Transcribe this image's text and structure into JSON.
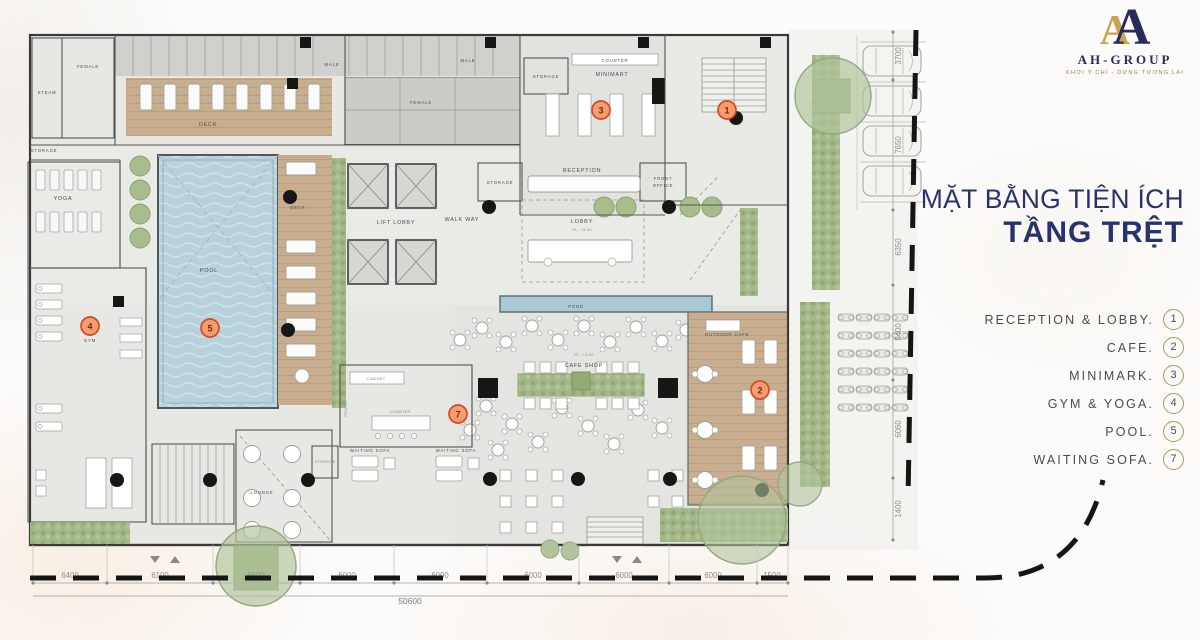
{
  "logo": {
    "letter": "A",
    "brand": "AH-GROUP",
    "tagline": "KHƠI Ý CHÍ - DỰNG TƯƠNG LAI"
  },
  "title": {
    "line1": "MẶT BẰNG TIỆN ÍCH",
    "line2": "TẦNG TRỆT"
  },
  "legend": {
    "items": [
      {
        "label": "RECEPTION & LOBBY.",
        "num": "1"
      },
      {
        "label": "CAFE.",
        "num": "2"
      },
      {
        "label": "MINIMARK.",
        "num": "3"
      },
      {
        "label": "GYM & YOGA.",
        "num": "4"
      },
      {
        "label": "POOL.",
        "num": "5"
      },
      {
        "label": "WAITING SOFA.",
        "num": "7"
      }
    ]
  },
  "plan": {
    "rooms": {
      "steam": "STEAM",
      "female_a": "FEMALE",
      "male_a": "MALE",
      "male_b": "MALE",
      "female_b": "FEMALE",
      "deck_top": "DECK",
      "deck_right": "DECK",
      "storage_a": "STORAGE",
      "storage_b": "STORAGE",
      "storage_c": "STORAGE",
      "storage_d": "STORAGE",
      "counter_a": "COUNTER",
      "counter_b": "COUNTER",
      "minimart": "MINIMART",
      "reception": "RECEPTION",
      "front_office_1": "FRONT",
      "front_office_2": "OFFICE",
      "lobby": "LOBBY",
      "lift_lobby": "LIFT LOBBY",
      "walk_way": "WALK WAY",
      "yoga": "YOGA",
      "gym": "GYM",
      "pool": "POOL",
      "pond": "POND",
      "cafe_shop": "CAFE SHOP",
      "outdoor_cafe": "OUTDOOR CAFE",
      "waiting_a": "WAITING SOFA",
      "waiting_b": "WAITING SOFA",
      "cabinet": "CABINET",
      "pantry": "PANTRY",
      "lounge": "LOUNGE",
      "pl_a": "PL. +3.00",
      "pl_b": "PL. +3.00"
    },
    "markers": {
      "m1": "1",
      "m2": "2",
      "m3": "3",
      "m4": "4",
      "m5": "5",
      "m7": "7"
    },
    "dims": {
      "bottom": [
        "6400",
        "6100",
        "6600",
        "6000",
        "6000",
        "6000",
        "6000",
        "6000",
        "1500"
      ],
      "total": "50600",
      "right": [
        "3700",
        "7650",
        "6350",
        "5400",
        "6060",
        "1400"
      ]
    }
  },
  "colors": {
    "navy": "#26336e",
    "gold": "#c9a551",
    "marker_fill": "#f59d6e",
    "marker_ring": "#cf4a26",
    "legend_ring": "#b98f58",
    "pool_blue": "#b7d2da",
    "wood_tan": "#c8ae8e",
    "green": "#a3b789"
  }
}
